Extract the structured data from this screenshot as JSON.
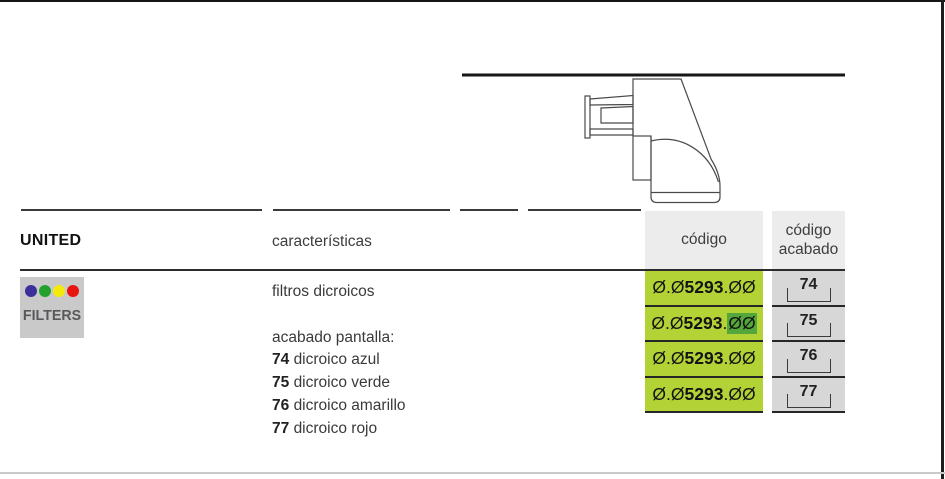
{
  "header": {
    "brand": "UNITED",
    "col_caracteristicas": "características",
    "col_codigo": "código",
    "col_codigo_acabado": "código acabado"
  },
  "product": {
    "badge": {
      "label": "FILTERS",
      "dot_colors": [
        "#3b2f9c",
        "#22a12d",
        "#f3ea0b",
        "#e8140f"
      ]
    },
    "caracteristicas": {
      "line1": "filtros dicroicos",
      "line2": "acabado pantalla:",
      "options": [
        {
          "num": "74",
          "label": "dicroico azul"
        },
        {
          "num": "75",
          "label": "dicroico verde"
        },
        {
          "num": "76",
          "label": "dicroico amarillo"
        },
        {
          "num": "77",
          "label": "dicroico rojo"
        }
      ]
    },
    "code_rows": [
      {
        "prefix": "Ø.Ø",
        "bold": "5293",
        "dot": ".",
        "tail": "ØØ",
        "finish": "74"
      },
      {
        "prefix": "Ø.Ø",
        "bold": "5293",
        "dot": ".",
        "tail": "ØØ",
        "finish": "75"
      },
      {
        "prefix": "Ø.Ø",
        "bold": "5293",
        "dot": ".",
        "tail": "ØØ",
        "finish": "76"
      },
      {
        "prefix": "Ø.Ø",
        "bold": "5293",
        "dot": ".",
        "tail": "ØØ",
        "finish": "77"
      }
    ]
  },
  "drawing": {
    "name": "wall-mounted luminaire side view"
  },
  "colors": {
    "code_cell_green": "#b3d236",
    "highlight_green": "#54a73b",
    "header_box_gray": "#ececec",
    "finish_cell_gray": "#d7d7d7",
    "badge_gray": "#c9c9c9"
  }
}
